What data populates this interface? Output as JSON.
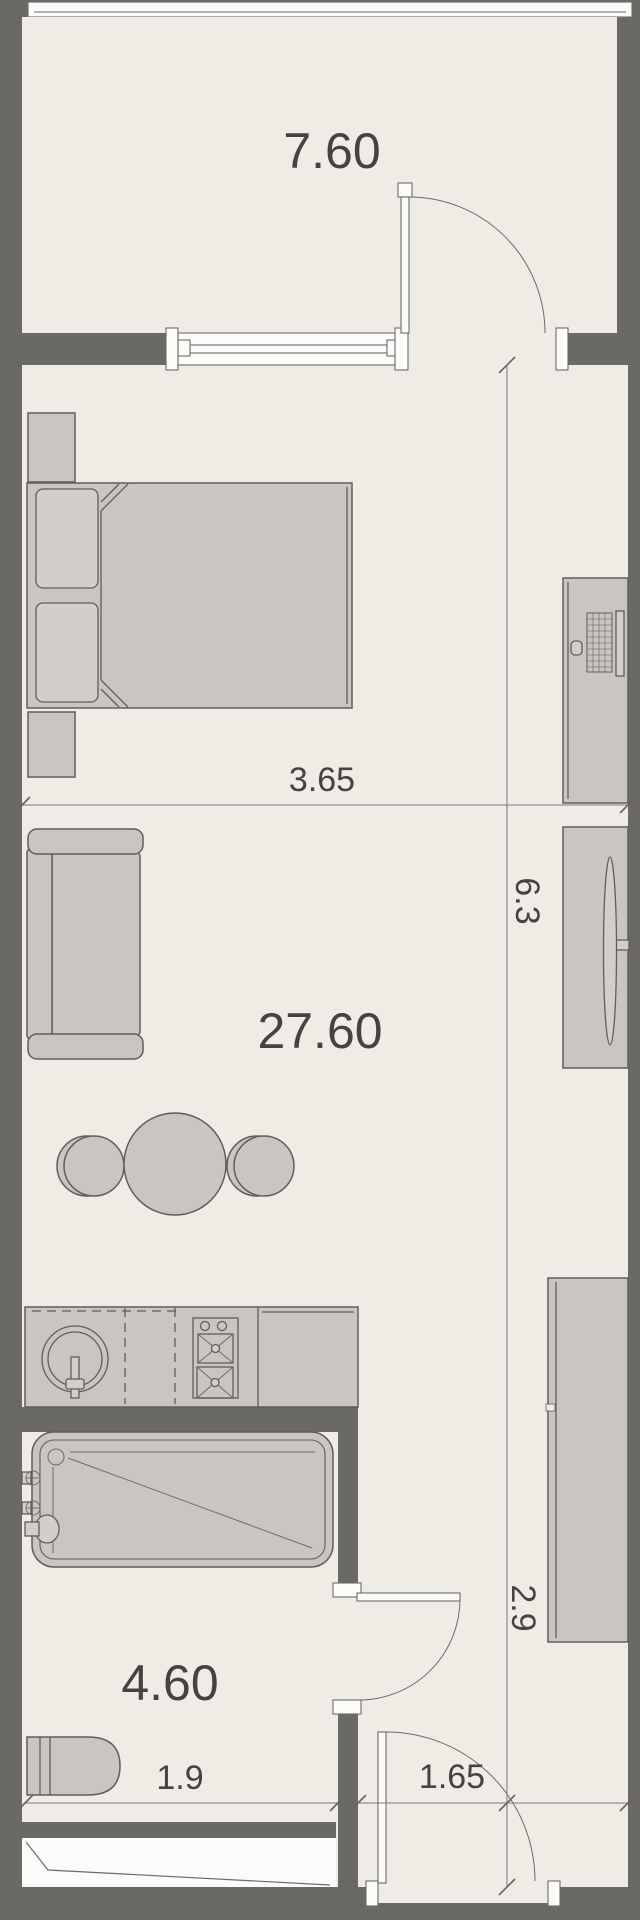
{
  "plan_type": "apartment-floor-plan",
  "rooms": {
    "balcony": {
      "area": "7.60"
    },
    "living_room": {
      "area": "27.60"
    },
    "bathroom": {
      "area": "4.60"
    }
  },
  "dimensions": {
    "living_width": "3.65",
    "living_length": "6.3",
    "hall_length": "2.9",
    "bathroom_width": "1.9",
    "hall_width": "1.65"
  },
  "colors": {
    "wall_and_outside": "#6b6966",
    "floor": "#efece6",
    "furniture_fill": "#c9c5c0",
    "furniture_light": "#d2cfca",
    "opening_white": "#fbfbfa",
    "outline": "#615d58",
    "dimension_line": "#7e7a76",
    "label_text": "#46433f"
  },
  "furniture": [
    "balcony-railing",
    "balcony-door",
    "window",
    "bed",
    "pillows",
    "duvet",
    "nightstands",
    "sofa",
    "coffee-tables",
    "desk",
    "keyboard",
    "mouse",
    "monitor",
    "tv-console",
    "tv",
    "wardrobe",
    "kitchen-counter",
    "sink",
    "faucet",
    "dishwasher-dashed",
    "stove",
    "bathtub",
    "bath-taps",
    "toilet",
    "bathroom-door",
    "entry-door"
  ]
}
